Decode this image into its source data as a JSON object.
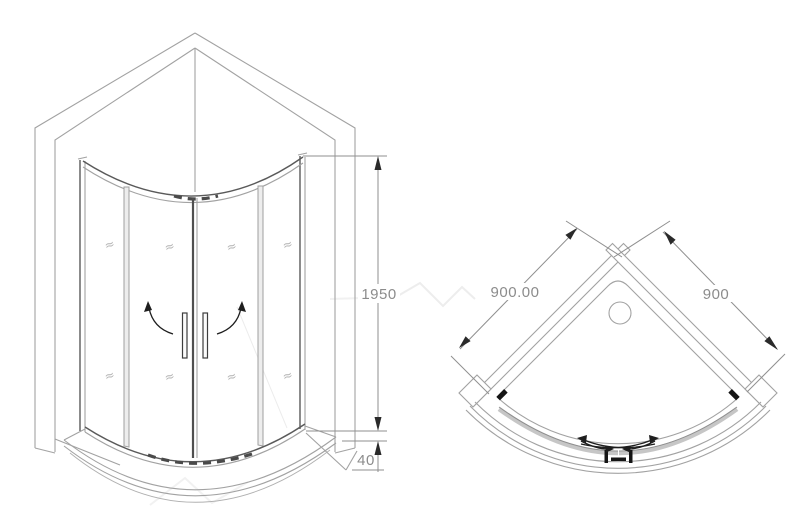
{
  "front_view": {
    "height_label": "1950",
    "tray_height_label": "40"
  },
  "plan_view": {
    "width_left_label": "900.00",
    "width_right_label": "900"
  },
  "icons": {
    "glass_mark": "≈"
  },
  "colors": {
    "line_gray": "#a2a2a2",
    "dark_accent": "#1e1e1e",
    "dimension_text": "#8c8c8c",
    "door_glass_gray": "#c6c6c6",
    "background": "#ffffff"
  }
}
